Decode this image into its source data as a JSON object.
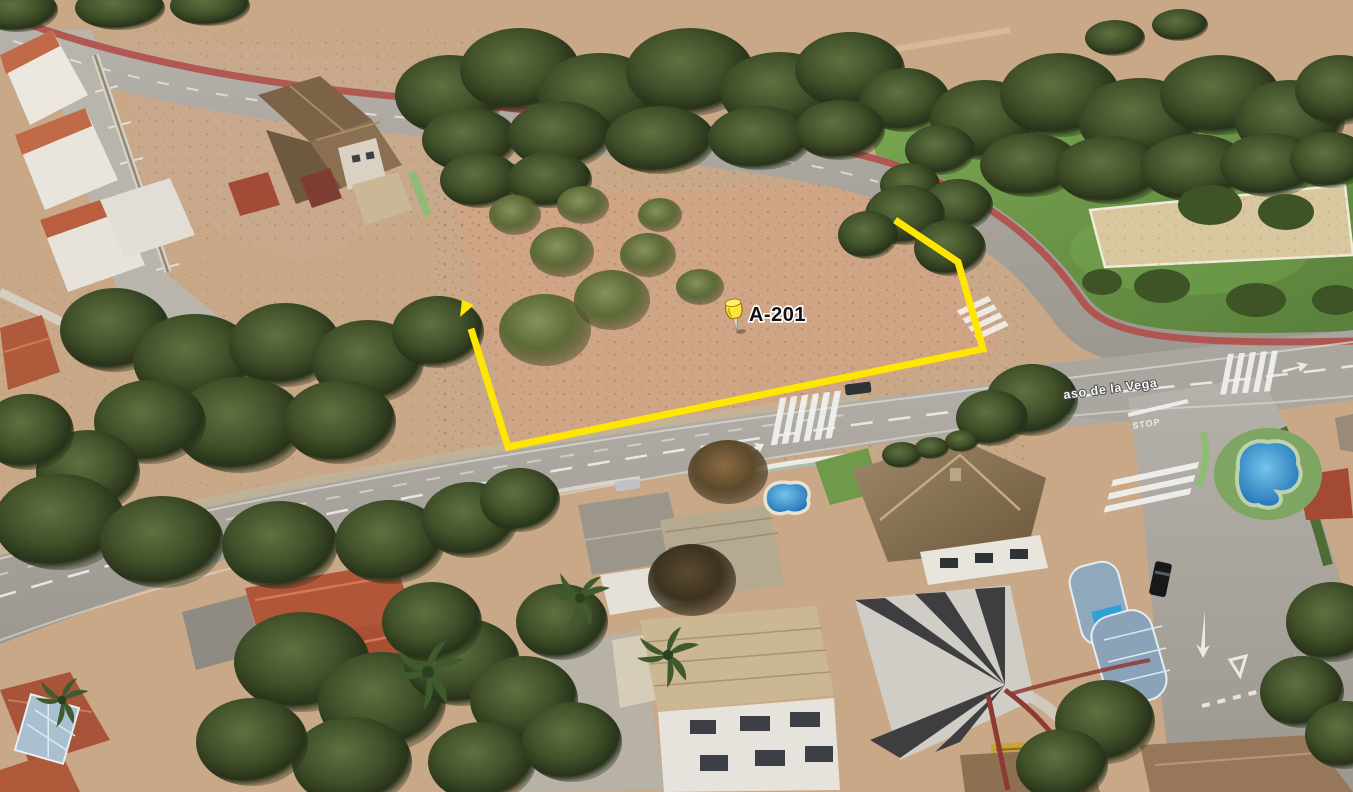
{
  "scene": {
    "kind": "oblique-aerial-3d-photo",
    "width_px": 1353,
    "height_px": 792,
    "description": "Google-Earth style oblique aerial view of a Mediterranean residential neighborhood: pine woodland, a vacant dirt parcel outlined in yellow with a placemark pin, curving roads with a red cycle lane, crosswalks, villas with tiled roofs and swimming pools"
  },
  "parcel": {
    "label": "A-201",
    "outline_color": "#ffe600",
    "outline_points": "898,222 958,262 983,349 508,447 472,332",
    "corner_marker_points": "460,317 474,305 462,300",
    "pin": {
      "name": "yellow-pushpin",
      "tip_x": 737,
      "tip_y": 331,
      "head_color": "#ffe43d",
      "outline_color": "#8a6d00"
    },
    "label_color": "#111111",
    "label_halo": "#ffffff"
  },
  "street": {
    "label_fragment": "aso de la Vega",
    "label_color": "#ffffff"
  },
  "road_markings": {
    "stop_text": "STOP",
    "marking_color": "#f2f2ee"
  },
  "palette": {
    "dirt": "#c9a888",
    "dirt_lot": "#cfa586",
    "forest_green": "#41512a",
    "olive_green": "#6b7a48",
    "lawn_green": "#6f9a49",
    "sand_court": "#d9c89f",
    "road_gray": "#a9a59f",
    "bike_lane_red": "#b0504a",
    "pool_blue": "#2f8ed6",
    "roof_terracotta": "#b2563a",
    "roof_brown": "#8a7355",
    "wall_white": "#e9e6df",
    "green_path": "#8fbc74",
    "boundary_yellow": "#ffe600"
  }
}
